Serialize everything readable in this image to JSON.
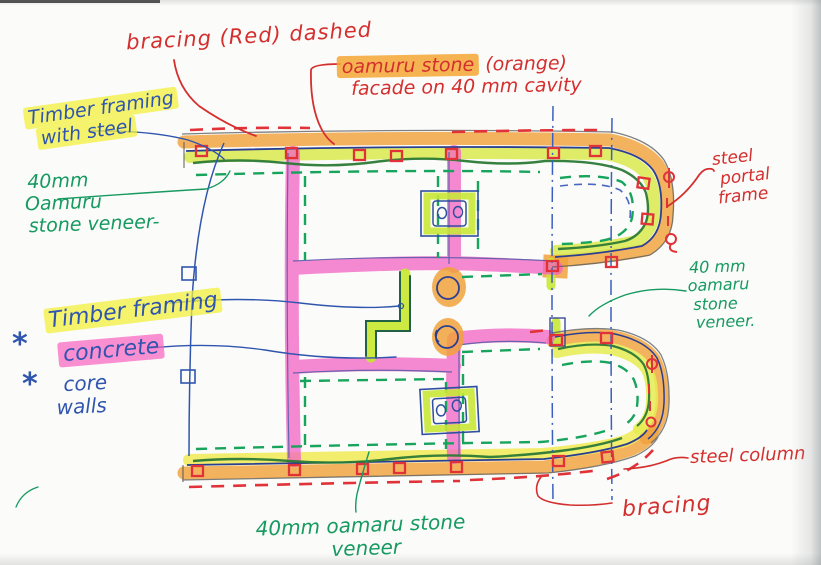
{
  "sketch": {
    "type": "hand-drawn structural floor plan",
    "labels": {
      "bracing_top": "bracing (Red) dashed",
      "facade_hl": "oamuru stone",
      "facade_rest": " (orange)",
      "facade_line2": "facade on 40 mm cavity",
      "timber_steel_1": "Timber framing",
      "timber_steel_2": "with steel",
      "veneer_left_1": "40mm",
      "veneer_left_2": "Oamuru",
      "veneer_left_3": "stone veneer-",
      "star_1": "*",
      "timber_framing": "Timber framing",
      "star_2": "*",
      "concrete": "concrete",
      "core_walls_1": "core",
      "core_walls_2": "walls",
      "steel_portal_1": "steel",
      "steel_portal_2": "portal",
      "steel_portal_3": "frame",
      "veneer_right_1": "40 mm",
      "veneer_right_2": "oamaru",
      "veneer_right_3": "stone",
      "veneer_right_4": "veneer.",
      "steel_column": "steel column",
      "bracing_bottom": "bracing",
      "veneer_bottom_1": "40mm oamaru stone",
      "veneer_bottom_2": "veneer"
    },
    "colors": {
      "red_ink": "#d42f2f",
      "blue_ink": "#2f55ae",
      "green_ink": "#169a60",
      "dark_green_line": "#2c7a36",
      "green_dash": "#17a45c",
      "orange_marker": "#f0a23c",
      "yellow_marker": "#eeea52",
      "chartreuse_marker": "#c9e836",
      "pink_marker": "#f263c5"
    }
  }
}
